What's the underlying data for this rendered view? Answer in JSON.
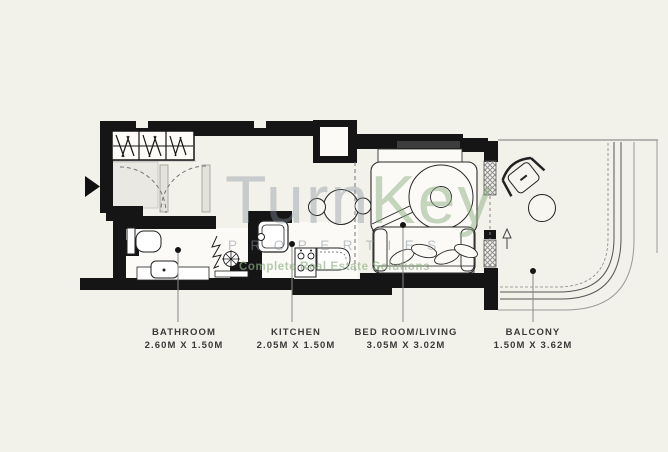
{
  "plan": {
    "rooms": [
      {
        "name": "BATHROOM",
        "dims": "2.60M X 1.50M"
      },
      {
        "name": "KITCHEN",
        "dims": "2.05M X 1.50M"
      },
      {
        "name": "BED ROOM/LIVING",
        "dims": "3.05M X 3.02M"
      },
      {
        "name": "BALCONY",
        "dims": "1.50M X 3.62M"
      }
    ]
  },
  "watermark": {
    "brand_part1": "Turn",
    "brand_part2": "Key",
    "subtitle": "PROPERTIES",
    "tagline": "Complete Real Estate Solutions"
  },
  "icons": {
    "entry": "entry-arrow",
    "balcony_direction": "up-arrow"
  },
  "colors": {
    "background": "#f2f1ea",
    "wall": "#151515",
    "line": "#2a2a2a",
    "leader": "#8a8a85",
    "label_text": "#3a3a37",
    "watermark_gray": "rgba(138,147,158,0.45)",
    "watermark_green": "rgba(146,178,136,0.68)"
  }
}
